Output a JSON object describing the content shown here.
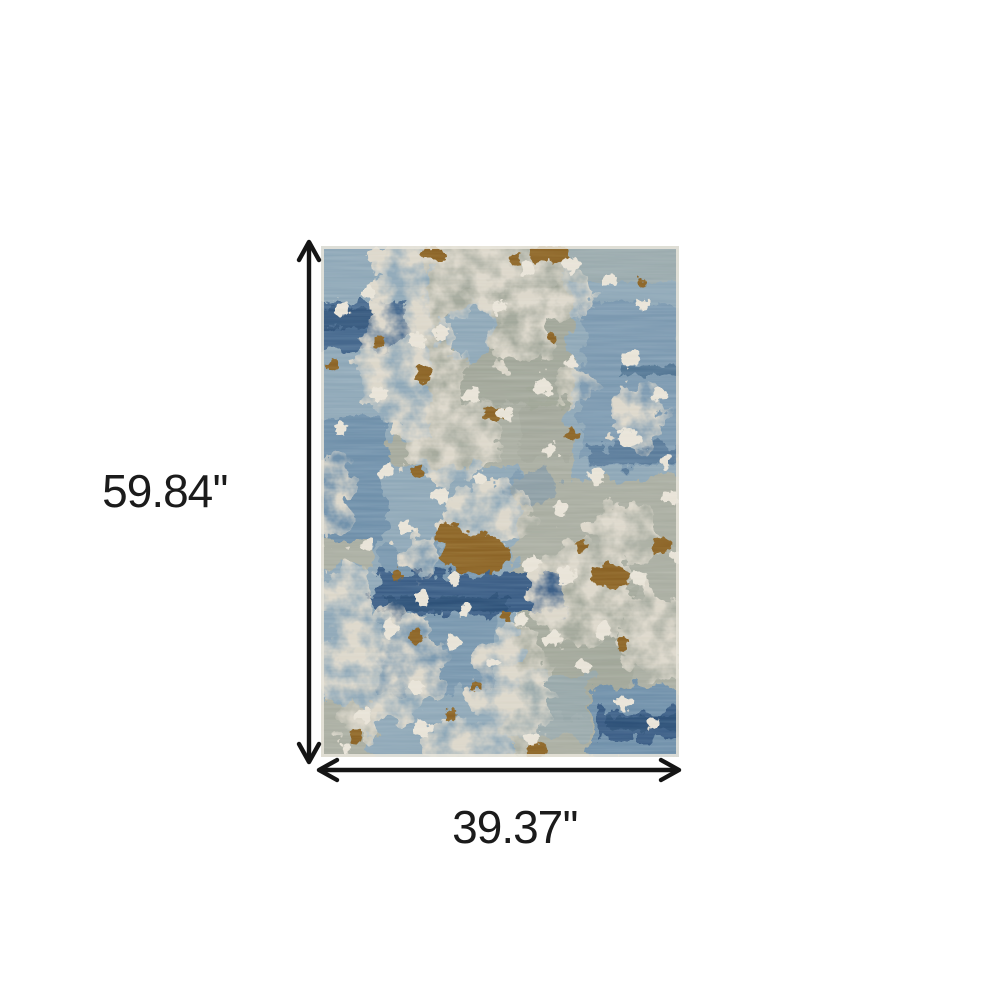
{
  "page": {
    "background": "#ffffff",
    "description_label": "rug-dimension-diagram"
  },
  "dimensions": {
    "height_label": "59.84''",
    "width_label": "39.37''",
    "arrow_color": "#151515",
    "text_color": "#1b1b1b"
  },
  "product": {
    "name": "abstract-area-rug",
    "palette": {
      "base": "#a9ada1",
      "base_dark": "#9aa092",
      "blue_light": "#8ea7b7",
      "blue_mid": "#6f90aa",
      "navy": "#3a5d85",
      "navy_dark": "#2e5178",
      "cream": "#dcd7ca",
      "cream_bright": "#e8e3d7",
      "rust": "#8b6326",
      "edge": "#eae6dc"
    }
  }
}
